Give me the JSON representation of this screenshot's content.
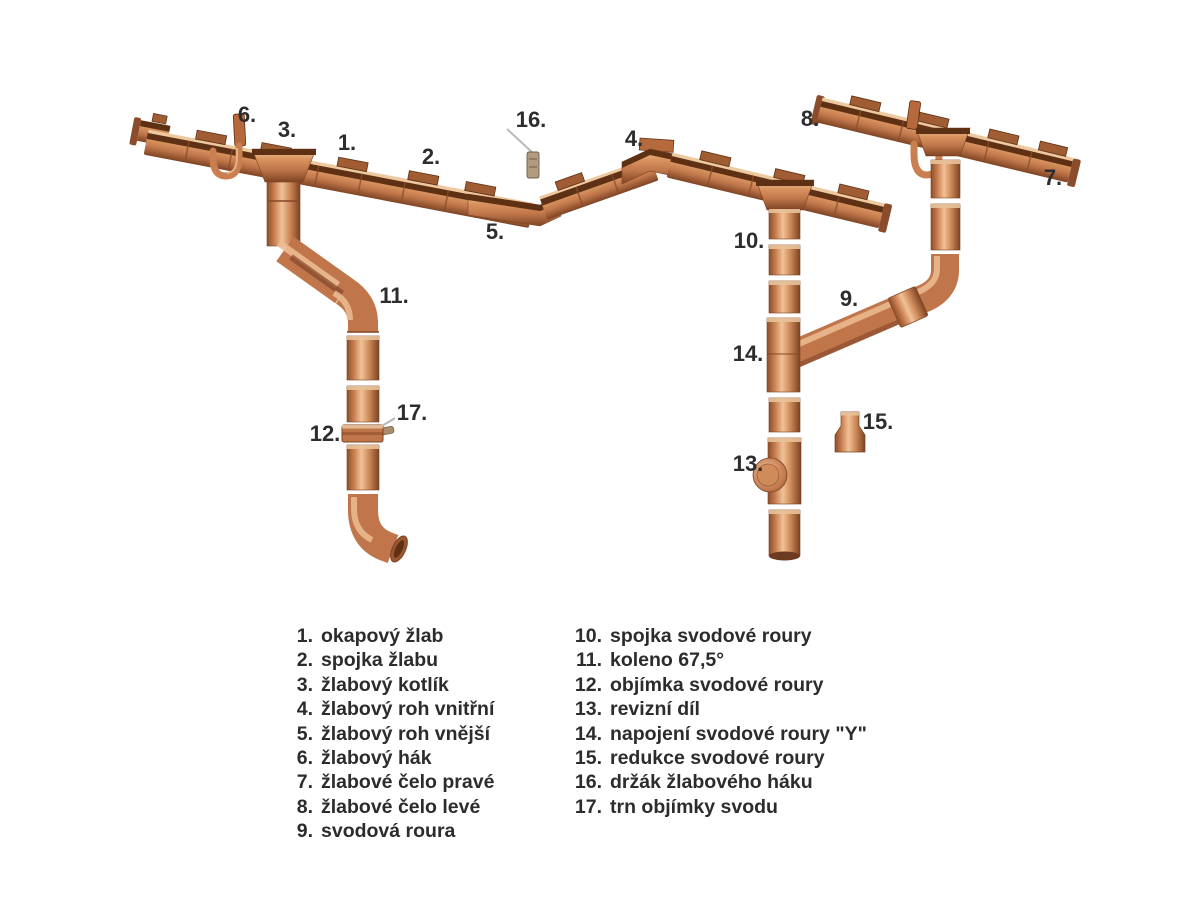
{
  "palette": {
    "copper_mid": "#c0764a",
    "copper_light": "#f0c298",
    "copper_dark": "#7c4223",
    "gutter_mouth": "#5e3014",
    "label_color": "#2d2d2d",
    "leader_gray": "#b8b8b8",
    "bracket_tan": "#b39b80",
    "background": "#ffffff"
  },
  "diagram": {
    "callouts": {
      "c1": "1.",
      "c2": "2.",
      "c3": "3.",
      "c4": "4.",
      "c5": "5.",
      "c6": "6.",
      "c7": "7.",
      "c8": "8.",
      "c9": "9.",
      "c10": "10.",
      "c11": "11.",
      "c12": "12.",
      "c13": "13.",
      "c14": "14.",
      "c15": "15.",
      "c16": "16.",
      "c17": "17."
    }
  },
  "legend": {
    "left": [
      {
        "num": "1.",
        "label": "okapový žlab"
      },
      {
        "num": "2.",
        "label": "spojka žlabu"
      },
      {
        "num": "3.",
        "label": "žlabový kotlík"
      },
      {
        "num": "4.",
        "label": "žlabový roh vnitřní"
      },
      {
        "num": "5.",
        "label": "žlabový roh vnější"
      },
      {
        "num": "6.",
        "label": "žlabový hák"
      },
      {
        "num": "7.",
        "label": "žlabové čelo pravé"
      },
      {
        "num": "8.",
        "label": "žlabové čelo levé"
      },
      {
        "num": "9.",
        "label": "svodová roura"
      }
    ],
    "right": [
      {
        "num": "10.",
        "label": "spojka svodové roury"
      },
      {
        "num": "11.",
        "label": "koleno 67,5°"
      },
      {
        "num": "12.",
        "label": "objímka svodové roury"
      },
      {
        "num": "13.",
        "label": "revizní díl"
      },
      {
        "num": "14.",
        "label": "napojení svodové roury \"Y\""
      },
      {
        "num": "15.",
        "label": "redukce svodové roury"
      },
      {
        "num": "16.",
        "label": "držák žlabového háku"
      },
      {
        "num": "17.",
        "label": "trn objímky svodu"
      }
    ]
  }
}
